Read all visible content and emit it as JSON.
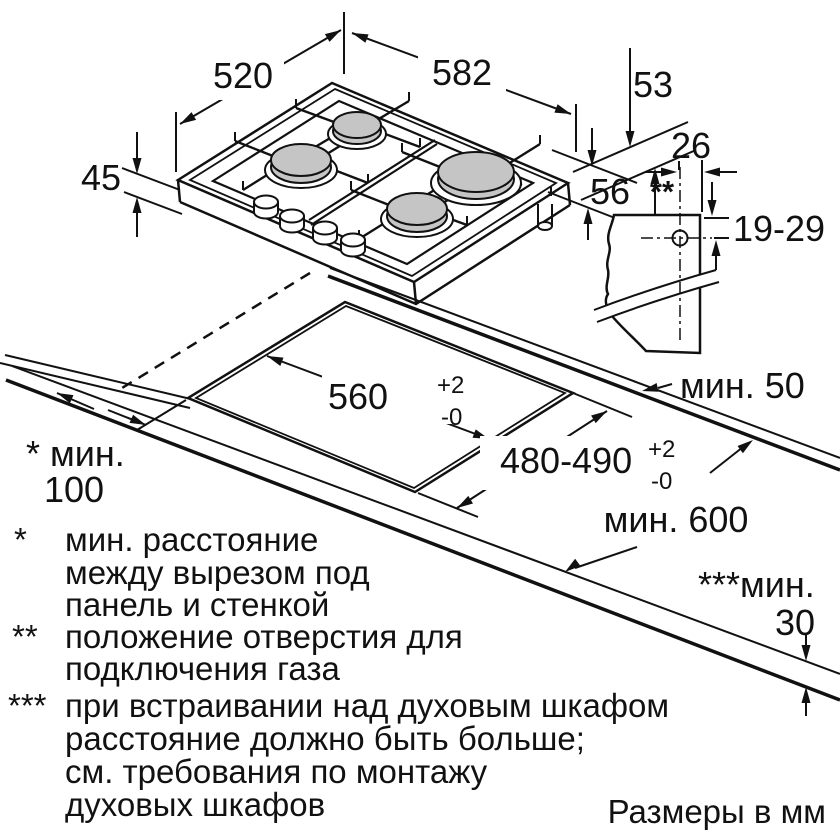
{
  "diagram": {
    "type": "installation-drawing",
    "appliance": "gas-hob-4-burners",
    "colors": {
      "line": "#111111",
      "burner_fill": "#c5c5c5",
      "background": "#ffffff"
    },
    "dims": {
      "depth": "520",
      "width": "582",
      "edge_height": "53",
      "height_left": "45",
      "height_right": "56",
      "gas_marker": "**",
      "gas_hole_offset": "26",
      "gas_hole_range": "19-29",
      "cutout_width": "560",
      "cutout_depth": "480-490",
      "tol_plus": "+2",
      "tol_minus": "-0",
      "min_back": "мин. 50",
      "min_depth": "мин. 600",
      "min_side_prefix": "* мин.",
      "min_side_value": "100",
      "min_oven_prefix": "***мин.",
      "min_oven_value": "30"
    },
    "footnotes": [
      {
        "marker": "*",
        "lines": [
          "мин. расстояние",
          "между вырезом под",
          "панель и стенкой"
        ]
      },
      {
        "marker": "**",
        "lines": [
          "положение отверстия для",
          "подключения газа"
        ]
      },
      {
        "marker": "***",
        "lines": [
          "при встраивании над духовым шкафом",
          "расстояние должно быть больше;",
          "см. требования по монтажу",
          "духовых шкафов"
        ]
      }
    ],
    "units_note": "Размеры в мм"
  }
}
